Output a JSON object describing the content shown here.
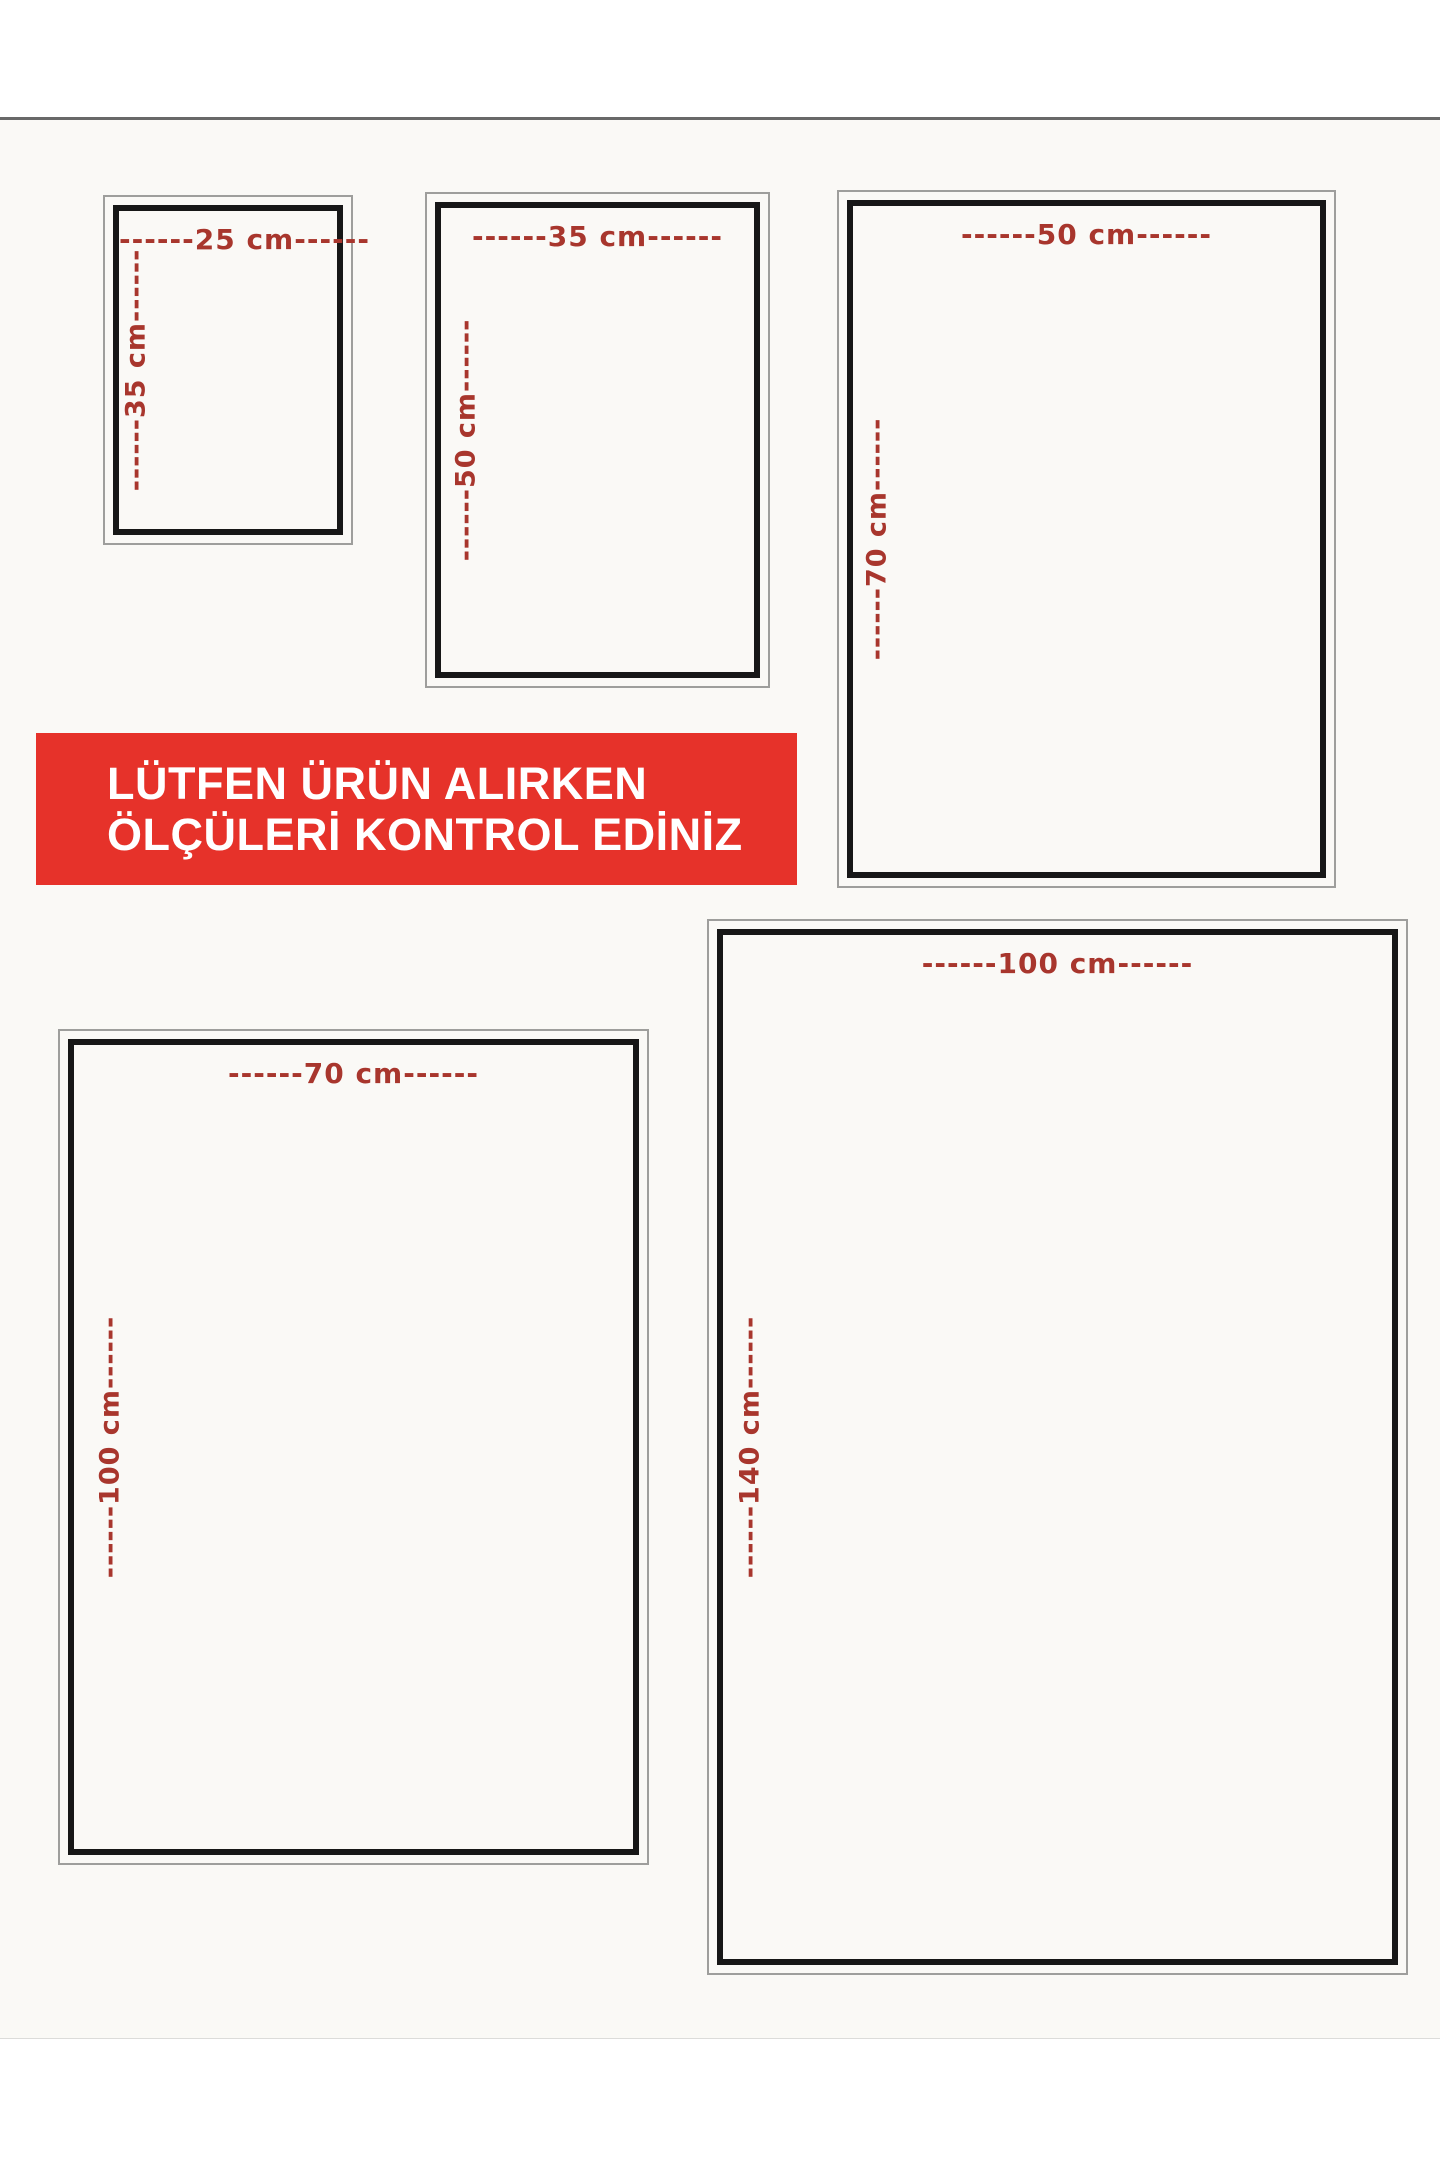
{
  "banner": {
    "line1": "LÜTFEN ÜRÜN ALIRKEN",
    "line2": "ÖLÇÜLERİ KONTROL EDİNİZ"
  },
  "colors": {
    "banner_bg": "#e6322a",
    "banner_text": "#ffffff",
    "dimension_label": "#a8362d",
    "frame_inner": "#171717",
    "frame_outer": "#9e9e9c",
    "card_bg": "#faf9f6",
    "page_bg": "#ffffff"
  },
  "sizes": [
    {
      "name": "25x35cm",
      "width_cm": 25,
      "height_cm": 35,
      "top_label": "------25 cm------",
      "side_label": "------35 cm------"
    },
    {
      "name": "35x50cm",
      "width_cm": 35,
      "height_cm": 50,
      "top_label": "------35 cm------",
      "side_label": "------50 cm------"
    },
    {
      "name": "50x70cm",
      "width_cm": 50,
      "height_cm": 70,
      "top_label": "------50 cm------",
      "side_label": "------70 cm------"
    },
    {
      "name": "70x100cm",
      "width_cm": 70,
      "height_cm": 100,
      "top_label": "------70 cm------",
      "side_label": "------100 cm------"
    },
    {
      "name": "100x140cm",
      "width_cm": 100,
      "height_cm": 140,
      "top_label": "------100 cm------",
      "side_label": "------140 cm------"
    }
  ]
}
